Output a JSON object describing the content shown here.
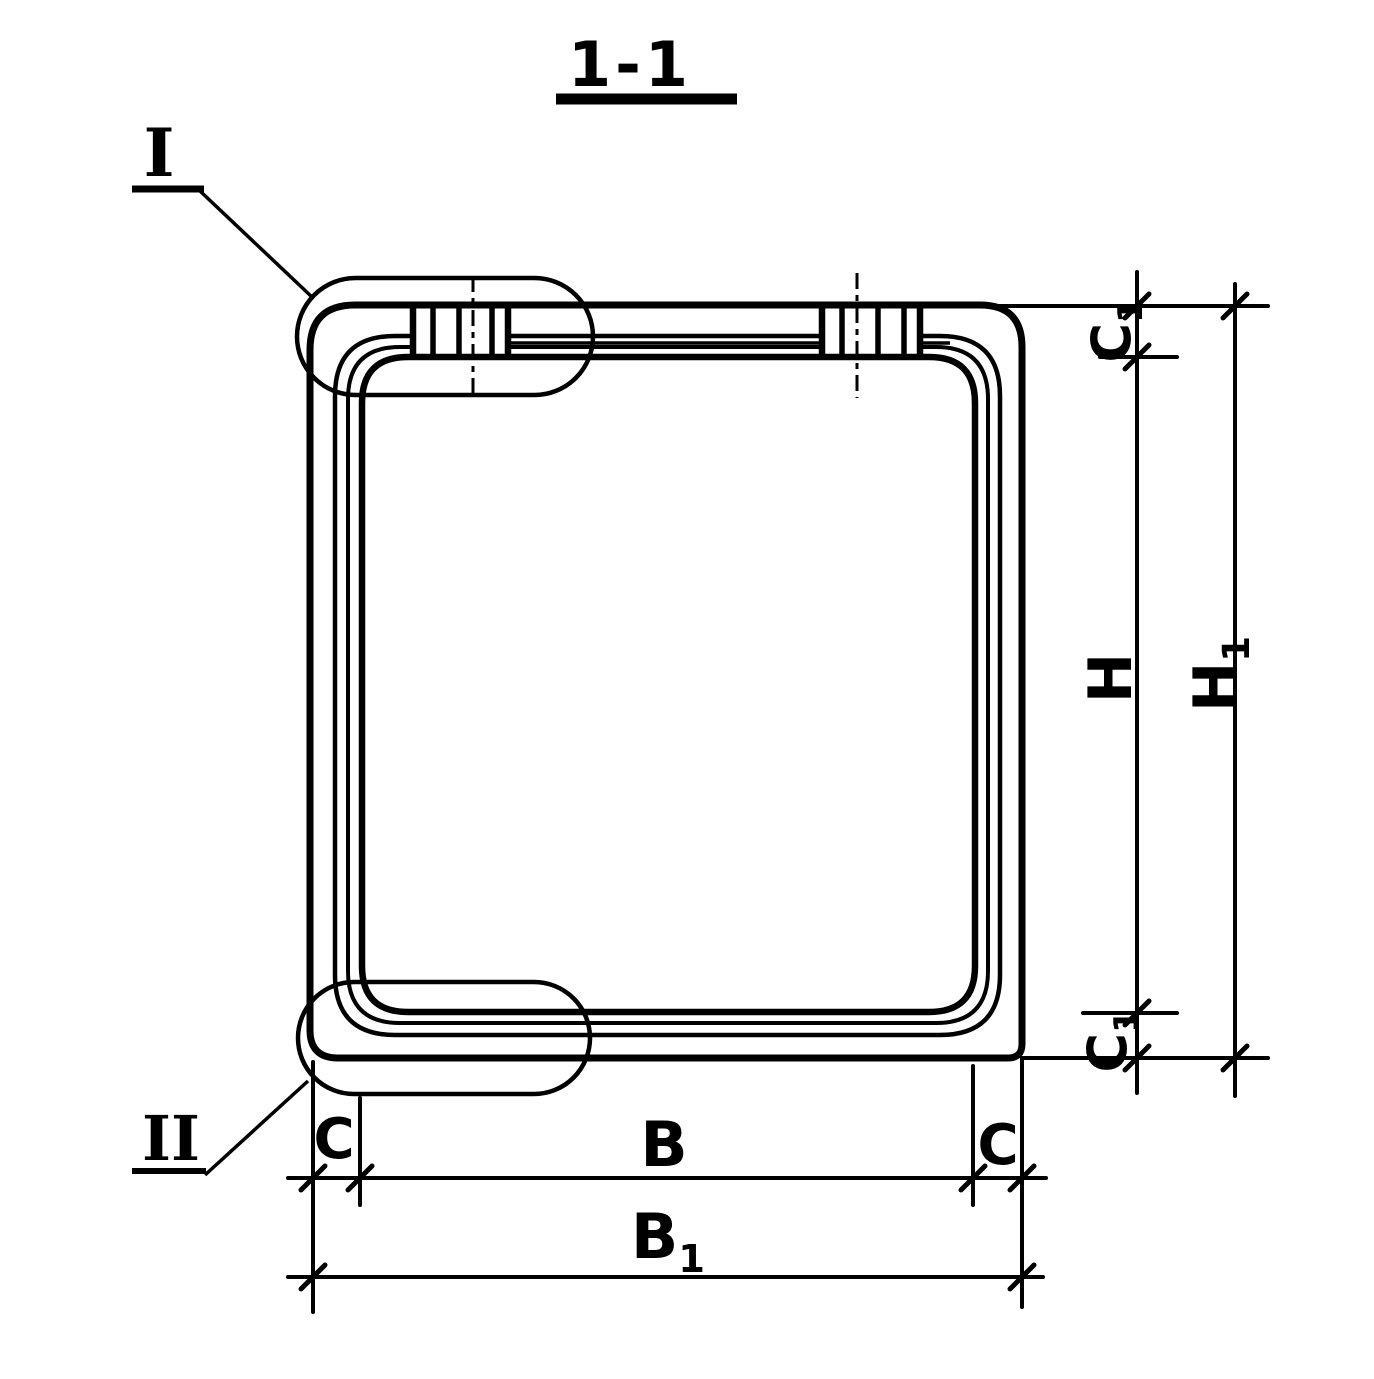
{
  "drawing": {
    "kind": "section-view",
    "title": {
      "label": "1-1"
    }
  },
  "details": {
    "top": {
      "label": "I"
    },
    "bottom": {
      "label": "II"
    }
  },
  "dims": {
    "c1_top": {
      "base": "C",
      "sub": "1"
    },
    "h": {
      "label": "H"
    },
    "h1": {
      "base": "H",
      "sub": "1"
    },
    "c1_bottom": {
      "base": "C",
      "sub": "1"
    },
    "c_left": {
      "label": "C"
    },
    "b": {
      "label": "B"
    },
    "c_right": {
      "label": "C"
    },
    "b1": {
      "base": "B",
      "sub": "1"
    }
  },
  "colors": {
    "ink": "#000000",
    "paper": "#ffffff"
  }
}
